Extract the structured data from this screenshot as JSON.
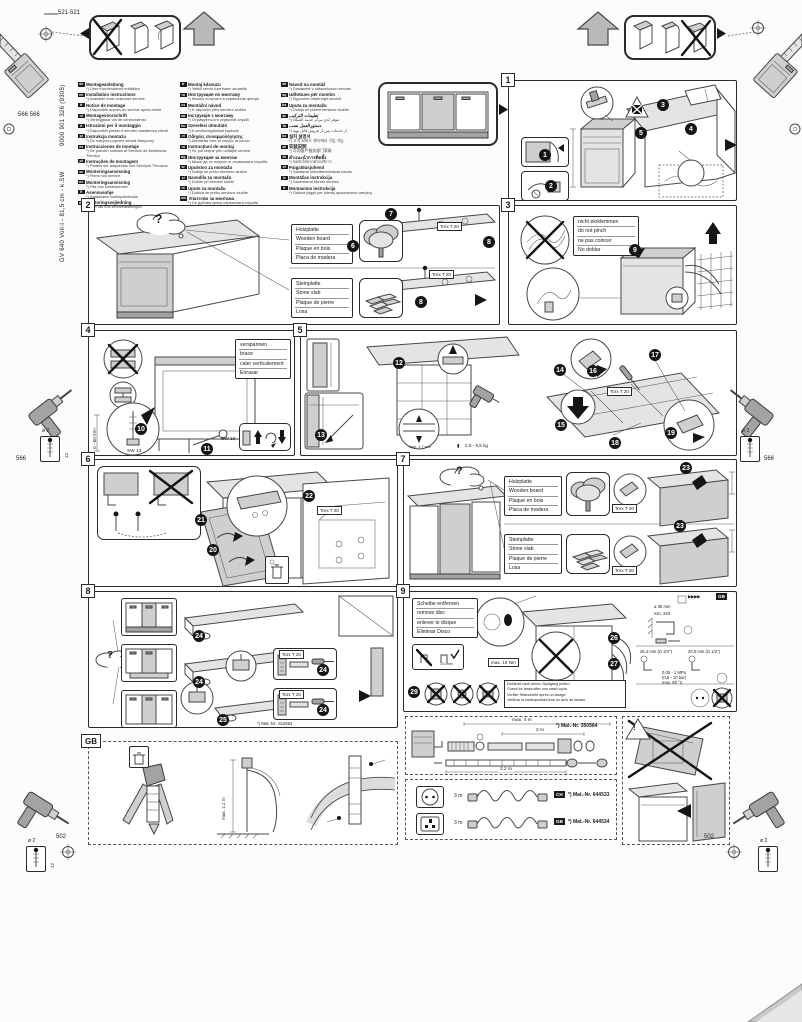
{
  "page": {
    "doc_number": "9000 901 326 (9305)",
    "model": "GV 640 Voll-I - 81,5 cm - k.SW"
  },
  "labels": {
    "question": "?",
    "warn": "!",
    "torx": "Torx T 20",
    "gb": "GB",
    "gb_arrows": "▶▶▶▶",
    "wood": [
      "Holzplatte",
      "Wooden board",
      "Plaque en bois",
      "Placa de madera"
    ],
    "stone": [
      "Steinplatte",
      "Stone slab",
      "Plaque de pierre",
      "Losa"
    ],
    "no_pinch": [
      "nicht einklemmen",
      "do not pinch",
      "ne pas coincer",
      "No doblar"
    ],
    "brace": [
      "verspannen",
      "brace",
      "caler verticalement",
      "Enrasar"
    ],
    "remove_disc": [
      "Scheibe entfernen",
      "remove disc",
      "enlever le disque",
      "Eliminar Disco"
    ],
    "leak_check": [
      "Dichtheit nach einem Spülgang prüfen.",
      "Check for leaks after one wash cycle.",
      "Vérifier l'étanchéité après un lavage.",
      "Verificar la estanqueidad tras un ciclo de lavado."
    ]
  },
  "margins": {
    "dim_top": "521-521",
    "dim_566_pair": "566 566",
    "dim_566_left": "566",
    "dim_566_right": "566",
    "dim_502_left": "502",
    "dim_502_right": "502",
    "drill_dia": "ø 2",
    "drill_depth": "12"
  },
  "measures": {
    "range_0_60": "0 - 60 mm",
    "sw13": "SW 13",
    "sw10": "SW 10",
    "gap": "max. 1,7 mm",
    "weight": "2,5 - 6,5 kg",
    "torque": "max. 10 Nm",
    "flow": "10 l/min",
    "dia35": "ø 35 mm",
    "min240": "min. 240",
    "size34": "26,4 mm (G 3/4\")",
    "size12": "20,0 mm (G 1/2\")",
    "pressure1": "0,05 - 1 MPa",
    "pressure2": "(0,5 - 10 bar)",
    "temp": "max. 60 °C",
    "hose_max": "max. 4 m",
    "hose_2m": "2 m",
    "hose_22m": "2,2 m",
    "cord_len_1": "3 m",
    "cord_len_2": "3 m",
    "standpipe": "max. 1,1 m",
    "mat_plinth": "*) Mat.-Nr.: 612663",
    "mat_hose": "*) Mat.-Nr. 350564",
    "mat_cord_ch": "*) Mat.-Nr. 644533",
    "mat_cord_gb": "*) Mat.-Nr. 644534",
    "badge_ch": "CH",
    "badge_gb": "GB"
  },
  "panels": {
    "p1": "1",
    "p2": "2",
    "p3": "3",
    "p4": "4",
    "p5": "5",
    "p6": "6",
    "p7": "7",
    "p8": "8",
    "p9": "9"
  },
  "steps": {
    "s1": "1",
    "s2": "2",
    "s3": "3",
    "s4": "4",
    "s5": "5",
    "s6": "6",
    "s7": "7",
    "s8": "8",
    "s9": "9",
    "s10": "10",
    "s11": "11",
    "s12": "12",
    "s13": "13",
    "s14": "14",
    "s15": "15",
    "s16": "16",
    "s17": "17",
    "s18": "18",
    "s19": "19",
    "s20": "20",
    "s21": "21",
    "s22": "22",
    "s23": "23",
    "s24": "24",
    "s25": "25",
    "s26": "26",
    "s27": "27",
    "s28": "28",
    "s29": "29"
  },
  "languages": {
    "col1": [
      {
        "code": "de",
        "title": "Montageanleitung",
        "note": "*) Über Kundendienst erhältlich"
      },
      {
        "code": "en",
        "title": "Installation instructions",
        "note": "*) Available from customer service"
      },
      {
        "code": "fr",
        "title": "Notice de montage",
        "note": "*) Disponible auprès du service après-vente"
      },
      {
        "code": "nl",
        "title": "Montagevoorschrift",
        "note": "*) Verkrijgbaar via de servicedienst"
      },
      {
        "code": "it",
        "title": "Istruzioni per il montaggio",
        "note": "*) Disponibili presso il servizio assistenza clienti"
      },
      {
        "code": "pl",
        "title": "Instrukcja montażu",
        "note": "*) Do nabycia poprzez serwis fabryczny"
      },
      {
        "code": "es",
        "title": "Instrucciones de montaje",
        "note": "*) Se pueden solicitar al Servicio de Asistencia Técnica"
      },
      {
        "code": "pt",
        "title": "Instruções de montagem",
        "note": "*) Podem ser adquiridas nos Serviços Técnicos"
      },
      {
        "code": "sv",
        "title": "Monteringsanvisning",
        "note": "*) Finns hos service"
      },
      {
        "code": "no",
        "title": "Monteringsanvisning",
        "note": "*) Fås hos kundeservice"
      },
      {
        "code": "fi",
        "title": "Asennusohje",
        "note": "*) Saatavana huoltopalvelusta"
      },
      {
        "code": "da",
        "title": "Monteringsvejledning",
        "note": "*) Kan fås hos serviceafdelingen"
      }
    ],
    "col2": [
      {
        "code": "tr",
        "title": "Montaj kılavuzu",
        "note": "*) Yetkili servis üzerinden alınabilir"
      },
      {
        "code": "ru",
        "title": "Инструкция по монтажу",
        "note": "*) Можно получить в сервисном центре"
      },
      {
        "code": "cs",
        "title": "Montážní návod",
        "note": "*) K dispozici přes servisní službu"
      },
      {
        "code": "uk",
        "title": "Інструкція з монтажу",
        "note": "*) Отримується в сервісній службі"
      },
      {
        "code": "hu",
        "title": "Szerelési útmutató",
        "note": "*) A vevőszolgálatnál kapható"
      },
      {
        "code": "el",
        "title": "Οδηγίες συναρμολόγησης",
        "note": "*) Διατίθεται από το σέρβις πελατών"
      },
      {
        "code": "ro",
        "title": "Instrucţiuni de montaj",
        "note": "*) Se pot obţine prin unităţile service"
      },
      {
        "code": "bg",
        "title": "Инструкция за монтаж",
        "note": "*) Може да се получи от сервизната служба"
      },
      {
        "code": "sr",
        "title": "Uputstvo za montažu",
        "note": "*) Dobija se preko servisne službe"
      },
      {
        "code": "sl",
        "title": "Navodila za montažo",
        "note": "*) Dobite pri servisni službi"
      },
      {
        "code": "hr",
        "title": "Upute za montažu",
        "note": "*) Dobiva se preko servisne službe"
      },
      {
        "code": "mk",
        "title": "Упатство за монтажа",
        "note": "*) Се добива преку сервисната служба"
      }
    ],
    "col3": [
      {
        "code": "sk",
        "title": "Návod na montáž",
        "note": "*) Dostanete v zákazníckom servise"
      },
      {
        "code": "sq",
        "title": "Udhëzues për montim",
        "note": "*) Sigurohet nëpërmjet servisit"
      },
      {
        "code": "bs",
        "title": "Uputa za montažu",
        "note": "*) Dobija se putem servisne službe"
      },
      {
        "code": "ar",
        "title": "تعليمات التركيب",
        "note": "*) تتوفر لدى مركز خدمة العملاء"
      },
      {
        "code": "fa",
        "title": "دستورالعمل نصب",
        "note": "*) از خدمات پس از فروش قابل تهیه"
      },
      {
        "code": "ko",
        "title": "설치 설명서",
        "note": "*) 고객 서비스 센터에서 구입 가능"
      },
      {
        "code": "zh",
        "title": "安装说明",
        "note": "*) 可向客户服务部门索取"
      },
      {
        "code": "th",
        "title": "คำแนะนำการติดตั้ง",
        "note": "*) ขอรับได้จากฝ่ายบริการ"
      },
      {
        "code": "et",
        "title": "Paigaldusjuhend",
        "note": "*) Saadaval klienditeeninduse kaudu"
      },
      {
        "code": "lv",
        "title": "Montāžas instrukcija",
        "note": "*) Saņemama klientu servisā"
      },
      {
        "code": "lt",
        "title": "Montavimo instrukcija",
        "note": "*) Galima įsigyti per klientų aptarnavimo tarnybą"
      }
    ]
  }
}
